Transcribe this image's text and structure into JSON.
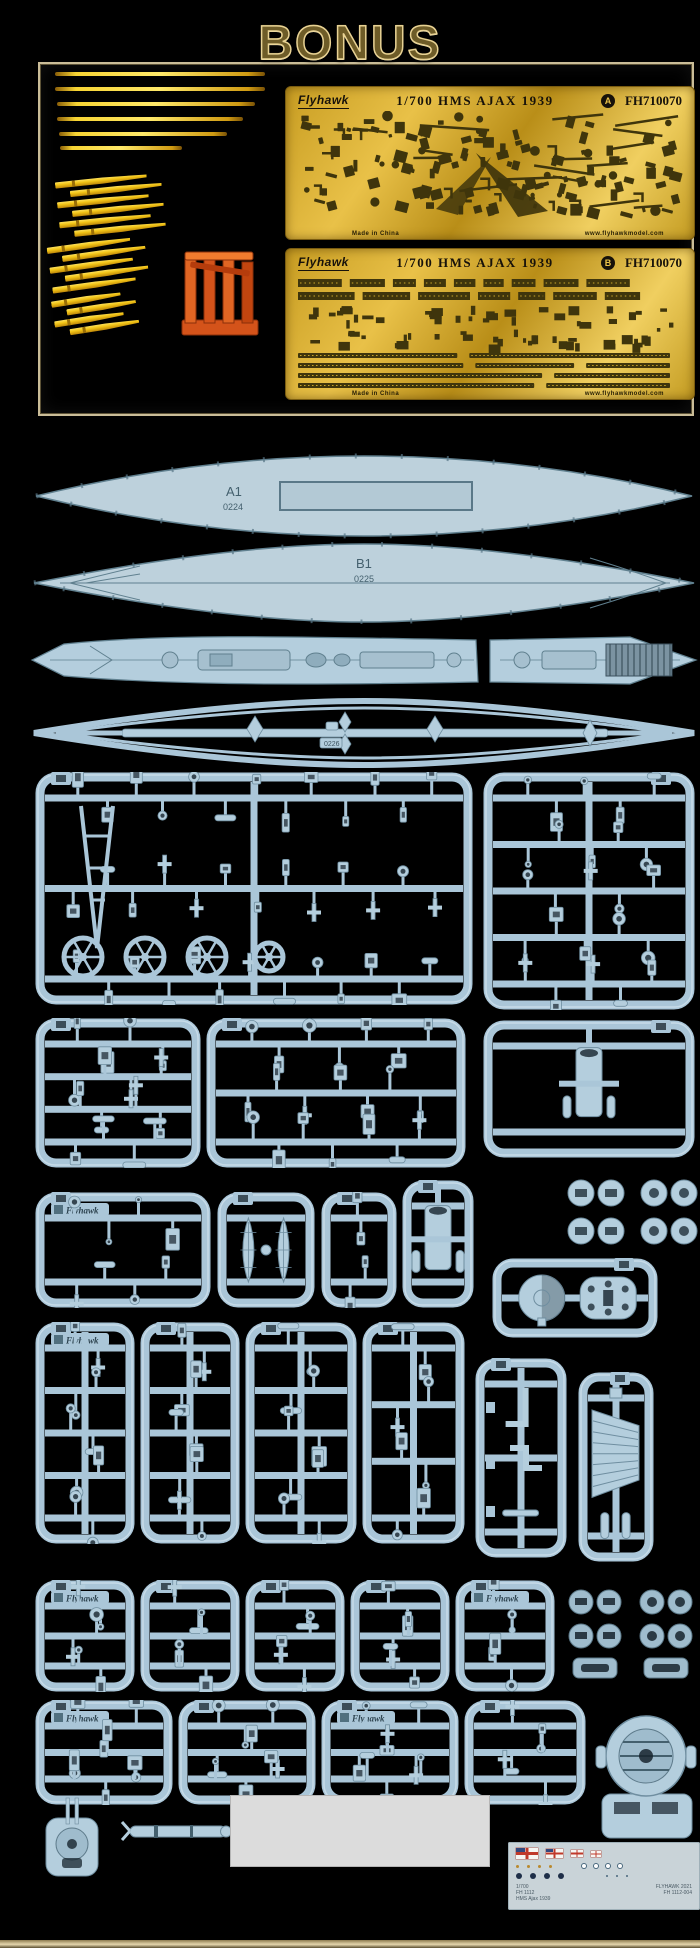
{
  "bonus": {
    "title": "BONUS"
  },
  "pe_frets": {
    "brand": "Flyhawk",
    "scale_title": "1/700 HMS AJAX 1939",
    "code": "FH710070",
    "letters": [
      "A",
      "B"
    ],
    "made_in": "Made in China",
    "website": "www.flyhawkmodel.com"
  },
  "parts_labels": {
    "a1": "A1",
    "a1_no": "0224",
    "b1": "B1",
    "b1_no": "0225",
    "lower_hull_no": "0226"
  },
  "sprue_plate_text": "Flyhawk",
  "decal_sheet": {
    "left_lines": [
      "1/700",
      "FH 1112",
      "HMS Ajax 1939"
    ],
    "right_lines": [
      "FLYHAWK 2021",
      "FH 1112-004"
    ]
  },
  "colors": {
    "plastic": "#b4cedd",
    "plastic_frame": "#aac6d8",
    "plastic_line": "#6f8ea0",
    "pe_dark": "#3f350c",
    "pe_gold_line": "#c9a62a",
    "barrel_yellow": "#f2c416",
    "orange": "#d4531a",
    "decal_bg": "#c9d3d8"
  },
  "bonus_metal": {
    "rods": [
      [
        55,
        72,
        210
      ],
      [
        55,
        87,
        210
      ],
      [
        57,
        102,
        198
      ],
      [
        57,
        117,
        186
      ],
      [
        59,
        132,
        168
      ],
      [
        60,
        146,
        122
      ]
    ],
    "bundles": [
      {
        "x": 58,
        "y": 176,
        "rot": -6,
        "count": 6,
        "len": 92
      },
      {
        "x": 50,
        "y": 240,
        "rot": -8,
        "count": 5,
        "len": 84
      },
      {
        "x": 54,
        "y": 294,
        "rot": -9,
        "count": 4,
        "len": 70
      }
    ]
  },
  "sprues": [
    {
      "x": 35,
      "y": 772,
      "w": 438,
      "h": 233,
      "seed": 11,
      "runners": 3,
      "feat": "circles"
    },
    {
      "x": 483,
      "y": 772,
      "w": 212,
      "h": 238,
      "seed": 22,
      "runners": 5,
      "tab": "r"
    },
    {
      "x": 35,
      "y": 1018,
      "w": 166,
      "h": 150,
      "seed": 33,
      "runners": 4
    },
    {
      "x": 206,
      "y": 1018,
      "w": 260,
      "h": 150,
      "seed": 44,
      "runners": 3
    },
    {
      "x": 483,
      "y": 1020,
      "w": 212,
      "h": 138,
      "seed": 55,
      "runners": 2,
      "feat": "sparse",
      "tab": "r"
    },
    {
      "x": 35,
      "y": 1192,
      "w": 176,
      "h": 116,
      "seed": 66,
      "runners": 2,
      "plate": true
    },
    {
      "x": 217,
      "y": 1192,
      "w": 98,
      "h": 116,
      "seed": 77,
      "runners": 2,
      "feat": "boats"
    },
    {
      "x": 321,
      "y": 1192,
      "w": 76,
      "h": 116,
      "seed": 88,
      "runners": 2
    },
    {
      "x": 402,
      "y": 1180,
      "w": 72,
      "h": 128,
      "seed": 99,
      "runners": 2,
      "feat": "sparse"
    },
    {
      "x": 492,
      "y": 1258,
      "w": 166,
      "h": 80,
      "seed": 101,
      "runners": 1,
      "feat": "tworound",
      "tab": "r"
    },
    {
      "x": 35,
      "y": 1322,
      "w": 100,
      "h": 222,
      "seed": 112,
      "runners": 5,
      "plate": true
    },
    {
      "x": 140,
      "y": 1322,
      "w": 100,
      "h": 222,
      "seed": 123,
      "runners": 5
    },
    {
      "x": 245,
      "y": 1322,
      "w": 112,
      "h": 222,
      "seed": 134,
      "runners": 5
    },
    {
      "x": 362,
      "y": 1322,
      "w": 103,
      "h": 222,
      "seed": 145,
      "runners": 4
    },
    {
      "x": 475,
      "y": 1358,
      "w": 92,
      "h": 200,
      "seed": 156,
      "runners": 3,
      "feat": "lparts"
    },
    {
      "x": 578,
      "y": 1372,
      "w": 76,
      "h": 190,
      "seed": 167,
      "runners": 2,
      "feat": "grille",
      "tab": "r"
    },
    {
      "x": 35,
      "y": 1580,
      "w": 100,
      "h": 112,
      "seed": 178,
      "runners": 3,
      "plate": true
    },
    {
      "x": 140,
      "y": 1580,
      "w": 100,
      "h": 112,
      "seed": 189,
      "runners": 3
    },
    {
      "x": 245,
      "y": 1580,
      "w": 100,
      "h": 112,
      "seed": 190,
      "runners": 3
    },
    {
      "x": 350,
      "y": 1580,
      "w": 100,
      "h": 112,
      "seed": 201,
      "runners": 3
    },
    {
      "x": 455,
      "y": 1580,
      "w": 100,
      "h": 112,
      "seed": 212,
      "runners": 3,
      "plate": true
    },
    {
      "x": 35,
      "y": 1700,
      "w": 138,
      "h": 105,
      "seed": 223,
      "runners": 3,
      "plate": true
    },
    {
      "x": 178,
      "y": 1700,
      "w": 138,
      "h": 105,
      "seed": 234,
      "runners": 3
    },
    {
      "x": 321,
      "y": 1700,
      "w": 138,
      "h": 105,
      "seed": 245,
      "runners": 3,
      "plate": true
    },
    {
      "x": 464,
      "y": 1700,
      "w": 122,
      "h": 105,
      "seed": 256,
      "runners": 3
    }
  ]
}
